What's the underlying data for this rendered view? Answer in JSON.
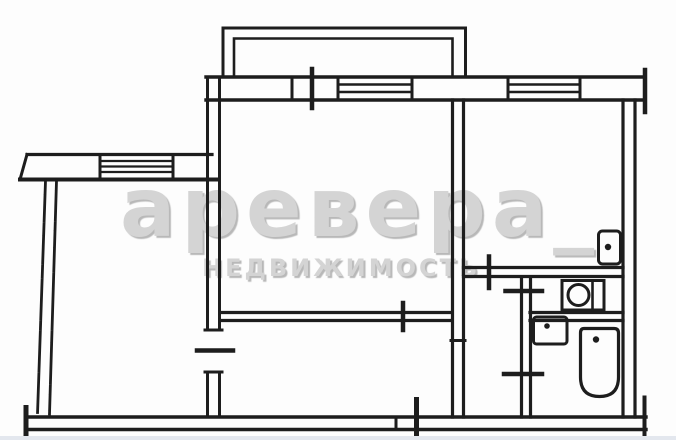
{
  "scan": {
    "background": "#fdfdfd",
    "ink_color": "#1d1d1d",
    "bottom_edge_strip_color": "#e3e7ee"
  },
  "watermark": {
    "line1": "аревера_",
    "line2": "НЕДВИЖИМОСТЬ",
    "color": "#d4d4d4"
  },
  "fixtures": {
    "kitchen_sink_icon": "kitchen-sink",
    "toilet_icon": "toilet",
    "wash_basin_icon": "wash-basin",
    "bathtub_icon": "bathtub"
  }
}
